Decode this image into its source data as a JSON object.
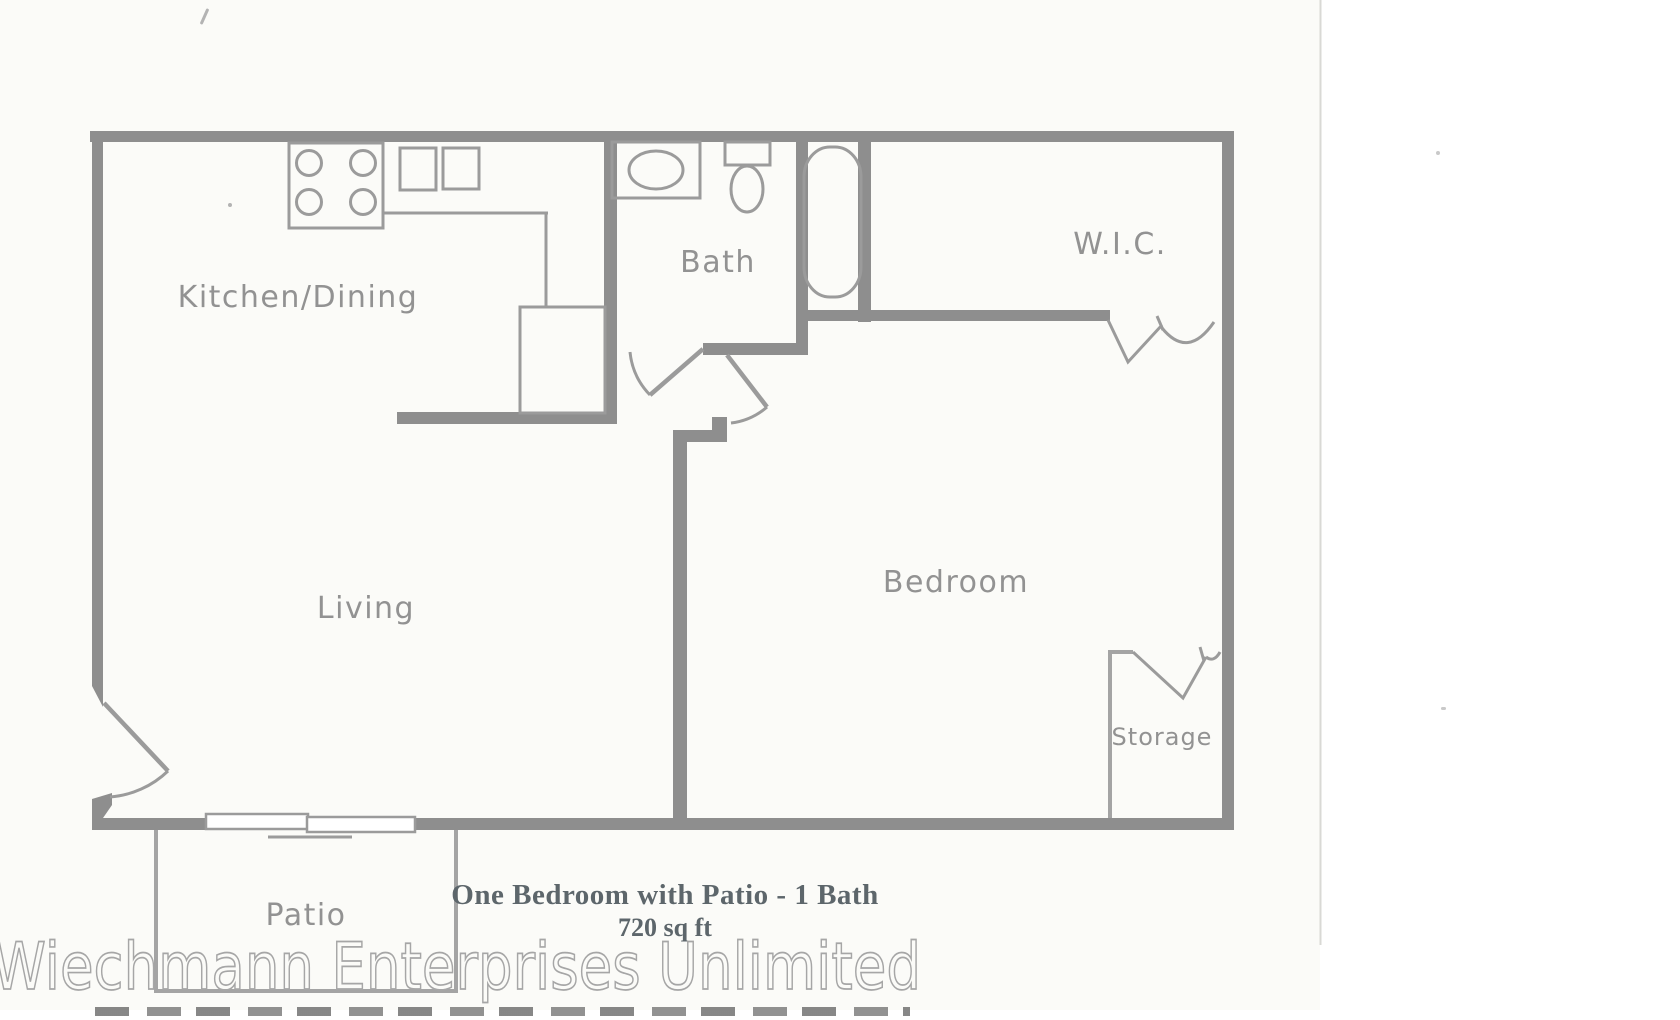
{
  "colors": {
    "wall": "#8e8e8e",
    "thin": "#a4a4a4",
    "fixture": "#9b9b9b",
    "label": "#8a8a8a",
    "caption": "#5d666b",
    "watermark": "#a6a6a6",
    "paper": "#fbfbf8",
    "edge": "#d9d9d5"
  },
  "rooms": {
    "kitchen_dining": "Kitchen/Dining",
    "bath": "Bath",
    "wic": "W.I.C.",
    "living": "Living",
    "bedroom": "Bedroom",
    "storage": "Storage",
    "patio": "Patio"
  },
  "caption": {
    "line1": "One Bedroom with Patio - 1 Bath",
    "line2": "720 sq ft"
  },
  "watermark": "Wiechmann Enterprises Unlimited",
  "fixtures": {
    "stove": "stove-4-burner",
    "kitchen_sink": "double-basin-sink",
    "refrigerator": "refrigerator",
    "bath_sink": "bathroom-sink",
    "toilet": "toilet",
    "bathtub": "bathtub",
    "sliding_door": "sliding-patio-door",
    "entry_door": "entry-door-swing",
    "bath_door": "bath-door-swing",
    "bedroom_door": "bedroom-door-swing",
    "wic_door": "bifold-closet-door",
    "storage_door": "bifold-closet-door"
  }
}
